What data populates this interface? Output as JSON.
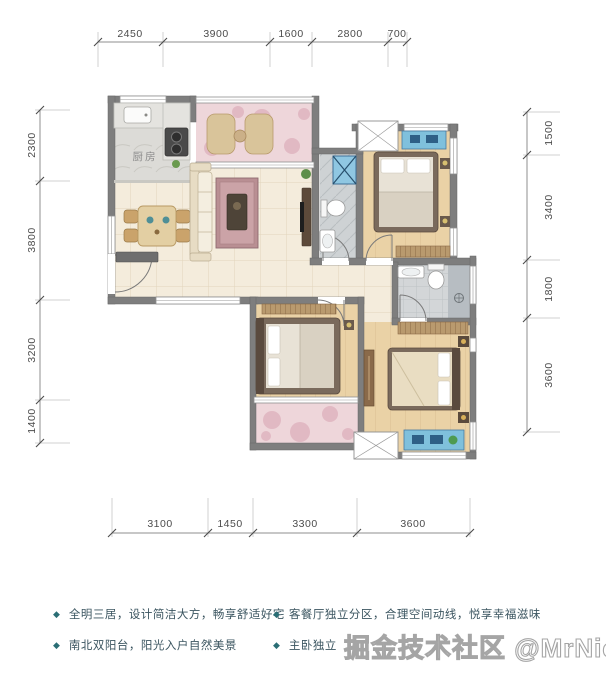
{
  "plan": {
    "kitchen_label": "厨房",
    "rulers": {
      "top": [
        "2450",
        "3900",
        "1600",
        "2800",
        "700"
      ],
      "left": [
        "2300",
        "3800",
        "3200",
        "1400"
      ],
      "right": [
        "1500",
        "3400",
        "1800",
        "3600"
      ],
      "bottom": [
        "3100",
        "1450",
        "3300",
        "3600"
      ]
    }
  },
  "features": {
    "bullet_glyph": "◆",
    "items": [
      "全明三居，设计简洁大方，畅享舒适好宅",
      "南北双阳台，阳光入户自然美景",
      "客餐厅独立分区，合理空间动线，悦享幸福滋味",
      "主卧独立"
    ]
  },
  "watermark": {
    "text": "掘金技术社区 @MrNiceGuy"
  },
  "colors": {
    "wall": "#7e7e7e",
    "floor_tile": "#f4ecdc",
    "floor_wood": "#ead2a6",
    "floor_bath": "#d3d6d8",
    "balcony_pink": "#eed6da",
    "accent_blue": "#7fc0dc",
    "bullet_teal": "#2a6e75",
    "feature_text": "#3b5560",
    "watermark_grey": "#8c8c8c"
  }
}
